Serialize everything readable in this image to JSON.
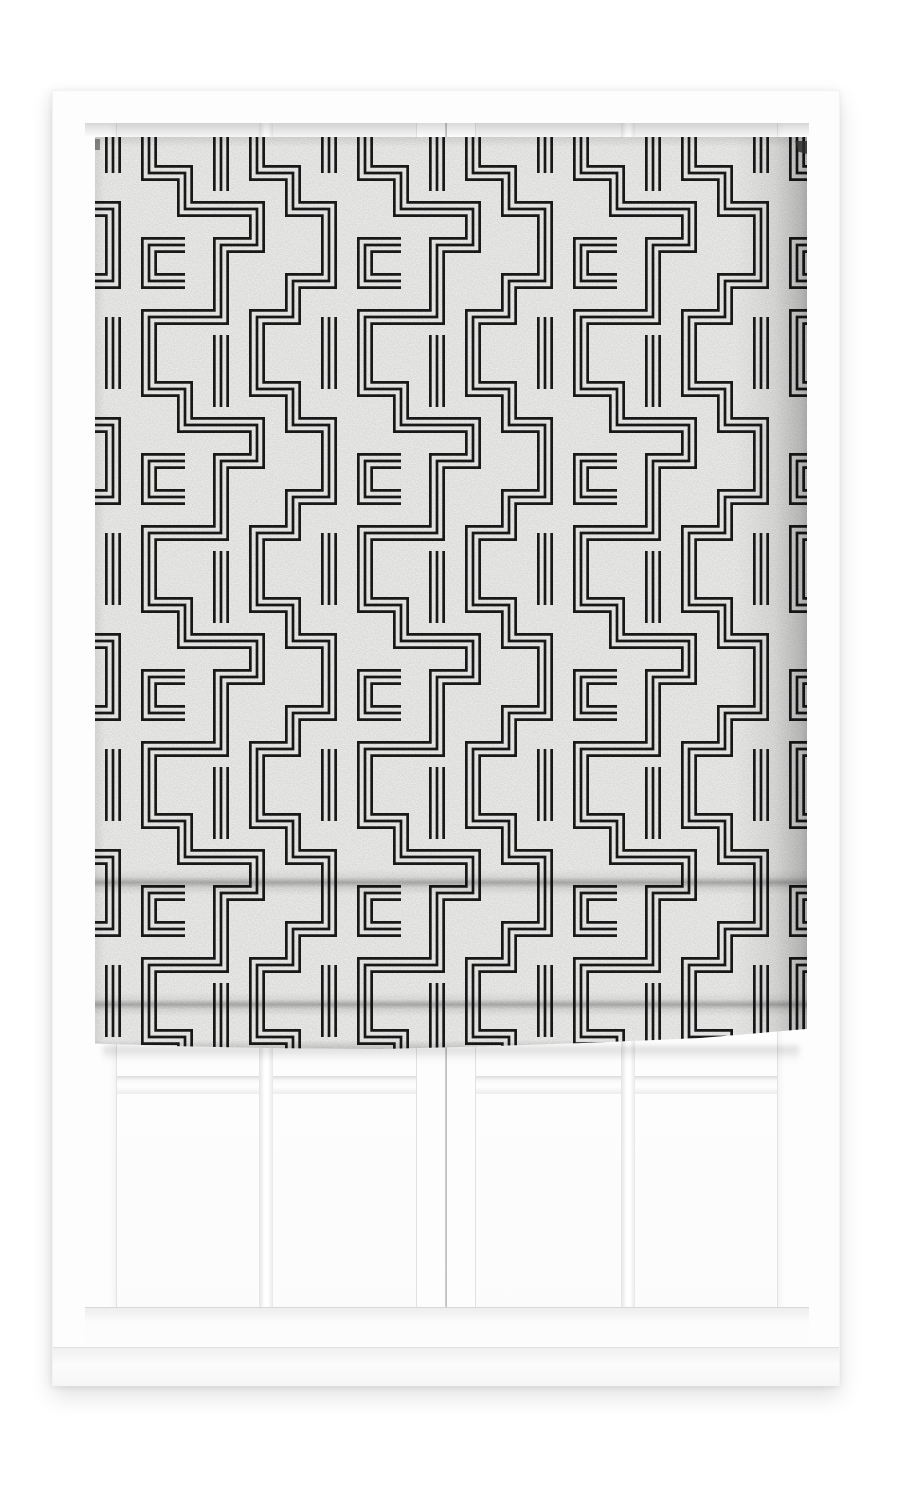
{
  "scene": {
    "type": "product photo",
    "subject": "Roman blind with black and white geometric maze pattern",
    "setting": "White window frame with two sashes and georgian-bar panes",
    "blind_state": "lowered over upper two-thirds with two soft horizontal folds"
  },
  "blind": {
    "pattern_style": "triple-line greek-key maze",
    "fold_count": 2,
    "hem": "gently uneven bottom edge"
  },
  "window": {
    "sash_count": 2,
    "panes_per_sash": 4,
    "visible_parts": "lower panes, muntin bars, bottom rail and sill"
  },
  "colors": {
    "page_background": "#ffffff",
    "frame_white": "#fdfdfd",
    "frame_shadow": "#e2e2e2",
    "fabric": "#f6f6f5",
    "pattern_black": "#1b1b1b",
    "glass": "#fdfdfd",
    "crease_shadow": "rgba(0,0,0,0.27)"
  }
}
